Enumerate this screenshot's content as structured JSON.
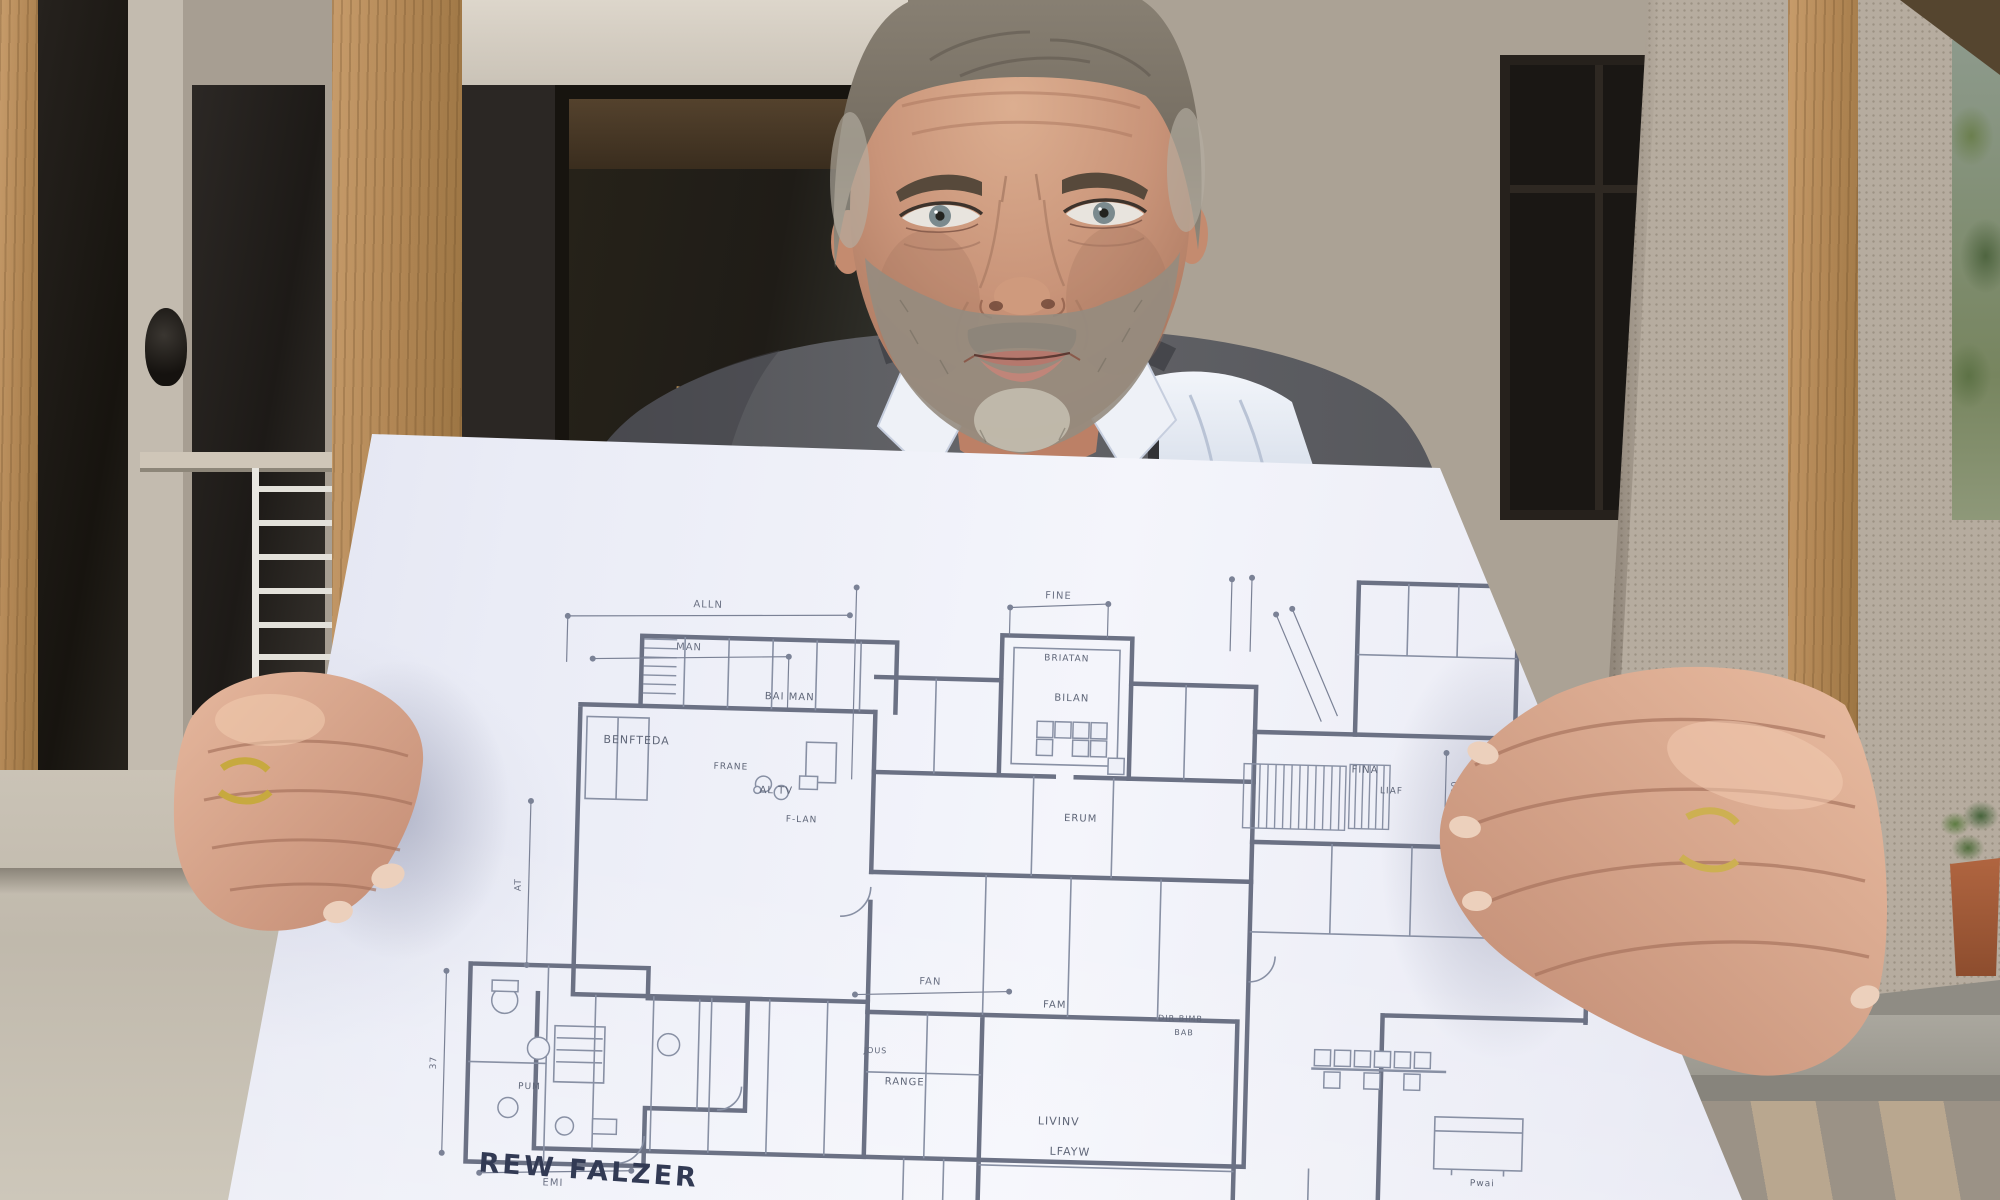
{
  "plan": {
    "signature": "REW FALZER",
    "ink_color": "#6b7184",
    "label_color": "#5f6678",
    "paper_color": "#eef0f8",
    "dimension_labels": [
      {
        "text": "ALLN",
        "x": 290,
        "y": 70,
        "size": 10,
        "rot": 0
      },
      {
        "text": "MAN",
        "x": 272,
        "y": 113,
        "size": 10,
        "rot": 0
      },
      {
        "text": "FINE",
        "x": 640,
        "y": 52,
        "size": 10,
        "rot": 0
      },
      {
        "text": "FAN",
        "x": 522,
        "y": 441,
        "size": 10,
        "rot": 0
      },
      {
        "text": "EMI",
        "x": 150,
        "y": 652,
        "size": 10,
        "rot": 0
      },
      {
        "text": "37",
        "x": 30,
        "y": 532,
        "size": 9,
        "rot": -90
      },
      {
        "text": "AT",
        "x": 110,
        "y": 352,
        "size": 9,
        "rot": -90
      },
      {
        "text": "30",
        "x": 1044,
        "y": 230,
        "size": 9,
        "rot": -90
      }
    ],
    "room_labels": [
      {
        "text": "BENFTEDA",
        "x": 222,
        "y": 208,
        "size": 11,
        "rot": 0
      },
      {
        "text": "BAI MAN",
        "x": 374,
        "y": 160,
        "size": 10,
        "rot": 0
      },
      {
        "text": "BRIATAN",
        "x": 650,
        "y": 114,
        "size": 9,
        "rot": 0
      },
      {
        "text": "BILAN",
        "x": 656,
        "y": 154,
        "size": 10,
        "rot": 0
      },
      {
        "text": "FRANE",
        "x": 317,
        "y": 231,
        "size": 9,
        "rot": 0
      },
      {
        "text": "AL TV",
        "x": 363,
        "y": 254,
        "size": 10,
        "rot": 0
      },
      {
        "text": "F-LAN",
        "x": 389,
        "y": 282,
        "size": 9,
        "rot": 0
      },
      {
        "text": "ERUM",
        "x": 668,
        "y": 274,
        "size": 10,
        "rot": 0
      },
      {
        "text": "FINA",
        "x": 951,
        "y": 218,
        "size": 10,
        "rot": 0
      },
      {
        "text": "LIAF",
        "x": 978,
        "y": 238,
        "size": 9,
        "rot": 0
      },
      {
        "text": "EW",
        "x": 1070,
        "y": 306,
        "size": 8,
        "rot": 0
      },
      {
        "text": "FAM",
        "x": 647,
        "y": 461,
        "size": 10,
        "rot": 0
      },
      {
        "text": "DIR BIMB",
        "x": 773,
        "y": 471,
        "size": 8,
        "rot": 0
      },
      {
        "text": "BAB",
        "x": 777,
        "y": 485,
        "size": 8,
        "rot": 0
      },
      {
        "text": "JOUS",
        "x": 469,
        "y": 511,
        "size": 8,
        "rot": 0
      },
      {
        "text": "RANGE",
        "x": 499,
        "y": 542,
        "size": 10,
        "rot": 0
      },
      {
        "text": "LIVINV",
        "x": 654,
        "y": 578,
        "size": 11,
        "rot": 0
      },
      {
        "text": "LFAYW",
        "x": 666,
        "y": 608,
        "size": 11,
        "rot": 0
      },
      {
        "text": "PUM",
        "x": 124,
        "y": 556,
        "size": 9,
        "rot": 0
      },
      {
        "text": "Pwai",
        "x": 1079,
        "y": 628,
        "size": 9,
        "rot": 0
      }
    ]
  },
  "palette": {
    "stucco_wall": "#b2a89b",
    "timber_post": "#b28755",
    "dark_glazing": "#1a1714",
    "sweater_gray": "#5d5e63",
    "shirt_white": "#e9edf5",
    "skin_tone": "#c99479",
    "terracotta_pot": "#a35a38",
    "foliage_green": "#5d7246",
    "stone_step": "#a5a299"
  }
}
